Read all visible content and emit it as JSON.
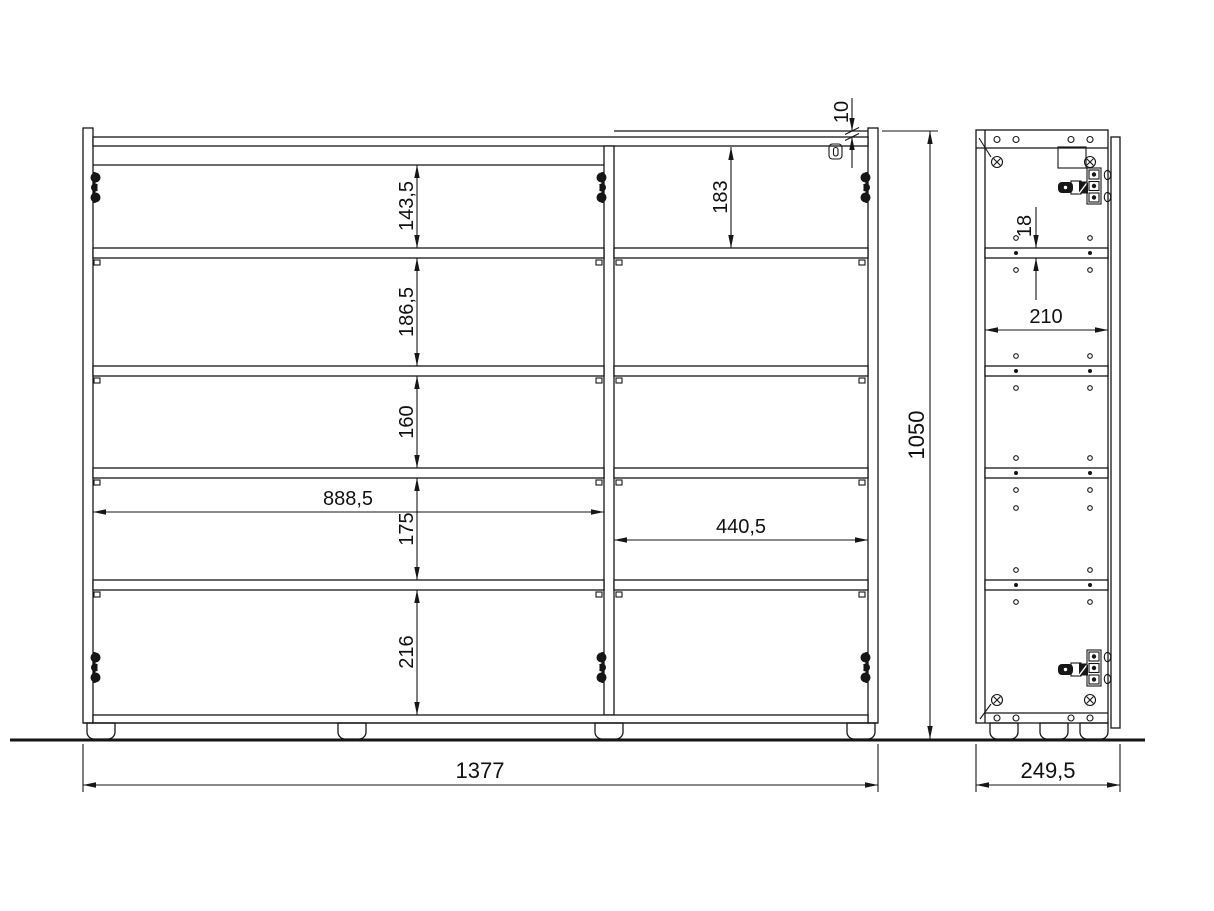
{
  "drawing": {
    "background": "#ffffff",
    "line_color": "#161616",
    "views": {
      "front": {
        "name": "front-elevation",
        "dimensions": {
          "top_gap": "10",
          "right_top_space": "183",
          "left_space_1": "143,5",
          "left_space_2": "186,5",
          "left_space_3": "160",
          "left_space_4": "175",
          "left_space_5": "216",
          "left_compartment_width": "888,5",
          "right_compartment_width": "440,5",
          "overall_width": "1377"
        }
      },
      "side": {
        "name": "side-section",
        "dimensions": {
          "shelf_thickness": "18",
          "interior_depth": "210",
          "overall_height": "1050",
          "overall_depth": "249,5"
        }
      }
    }
  }
}
